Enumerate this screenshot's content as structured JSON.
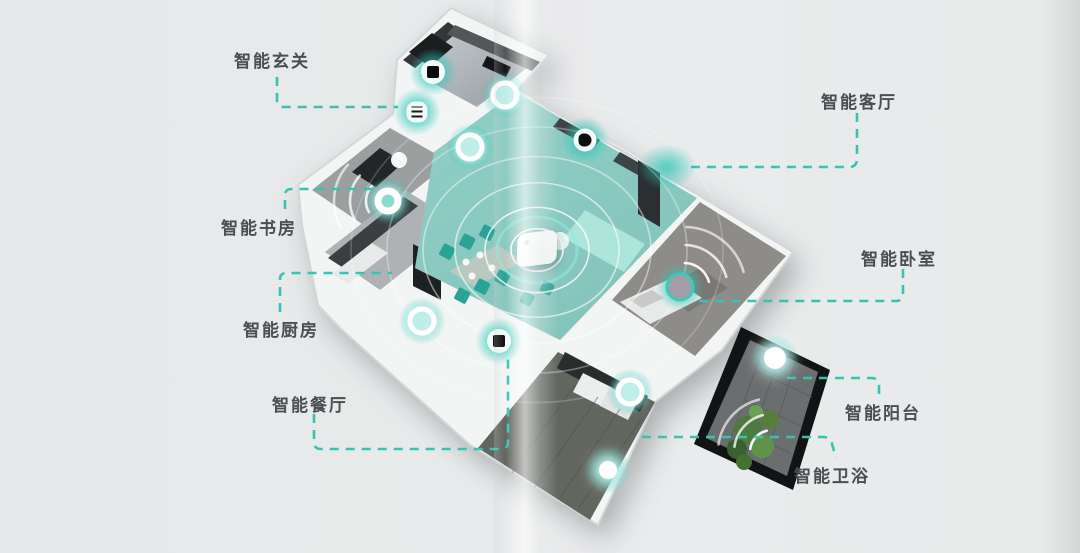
{
  "page": {
    "background_color": "#e9eaeb",
    "accent_color": "#36c2b4",
    "label_text_color": "#4a4e50",
    "description": "smart-home isometric floorplan diagram with dashed teal callouts"
  },
  "diagram": {
    "rooms": [
      {
        "id": "entry",
        "label": "智能玄关"
      },
      {
        "id": "living",
        "label": "智能客厅"
      },
      {
        "id": "study",
        "label": "智能书房"
      },
      {
        "id": "kitchen",
        "label": "智能厨房"
      },
      {
        "id": "dining",
        "label": "智能餐厅"
      },
      {
        "id": "bedroom",
        "label": "智能卧室"
      },
      {
        "id": "balcony",
        "label": "智能阳台"
      },
      {
        "id": "bathroom",
        "label": "智能卫浴"
      }
    ],
    "devices": [
      {
        "room": "entry",
        "marker": "wall-panel-icon"
      },
      {
        "room": "entry",
        "marker": "heater-grill-icon"
      },
      {
        "room": "living",
        "marker": "sensor-glow-icon"
      },
      {
        "room": "living",
        "marker": "light-glow-icon"
      },
      {
        "room": "living",
        "marker": "camera-glow-icon"
      },
      {
        "room": "living",
        "marker": "air-conditioner-glow"
      },
      {
        "room": "living",
        "marker": "gateway-hub"
      },
      {
        "room": "study",
        "marker": "air-purifier-ring-icon"
      },
      {
        "room": "kitchen",
        "marker": "sensor-glow-icon"
      },
      {
        "room": "dining",
        "marker": "wall-panel-icon"
      },
      {
        "room": "bedroom",
        "marker": "sensor-glow-icon"
      },
      {
        "room": "balcony",
        "marker": "light-glow-icon"
      },
      {
        "room": "bathroom",
        "marker": "sensor-glow-icon"
      },
      {
        "room": "bathroom",
        "marker": "light-glow-icon"
      }
    ]
  }
}
